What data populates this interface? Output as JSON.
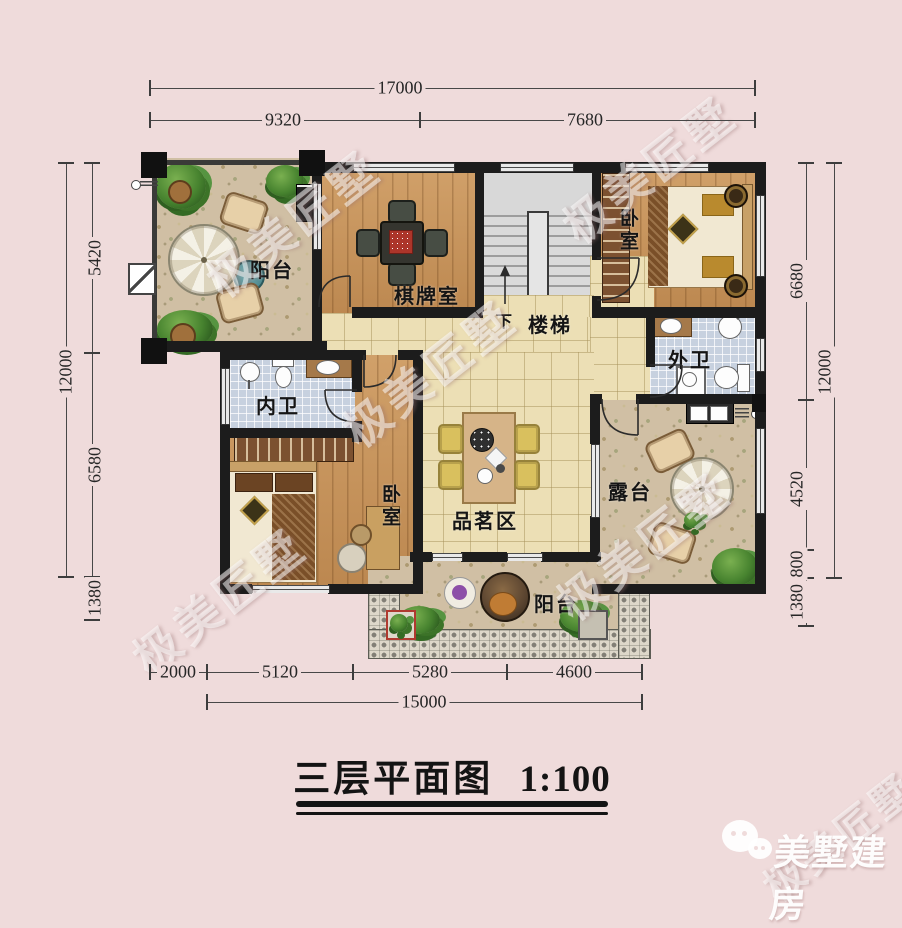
{
  "title": {
    "text": "三层平面图",
    "scale": "1:100"
  },
  "watermark": {
    "text": "极美匠墅"
  },
  "logo": {
    "text": "美墅建房",
    "icon": "chat-bubble-icon"
  },
  "dimensions": {
    "top": {
      "total": "17000",
      "segments": [
        "9320",
        "7680"
      ]
    },
    "left": {
      "total": "12000",
      "segments": [
        "5420",
        "6580",
        "1380"
      ]
    },
    "right": {
      "total": "12000",
      "segments": [
        "6680",
        "4520",
        "800",
        "1380"
      ]
    },
    "bottom": {
      "total": "15000",
      "segments": [
        "2000",
        "5120",
        "5280",
        "4600"
      ]
    }
  },
  "rooms": {
    "balcony_top": "阳台",
    "game_room": "棋牌室",
    "stairs": "楼梯",
    "stairs_down": "下",
    "bedroom_right": "卧室",
    "bath_outer": "外卫",
    "bath_inner": "内卫",
    "bedroom_left": "卧室",
    "tea_area": "品茗区",
    "terrace": "露台",
    "balcony_bottom": "阳台"
  },
  "colors": {
    "background": "#efdbdb",
    "wall": "#1c1c1c",
    "wood_floor": "#c9945a",
    "tile_floor": "#ecdfb5",
    "bath_tile": "#c7d1df",
    "floral_floor": "#d0bfa4",
    "mahjong_red": "#ac352a"
  }
}
